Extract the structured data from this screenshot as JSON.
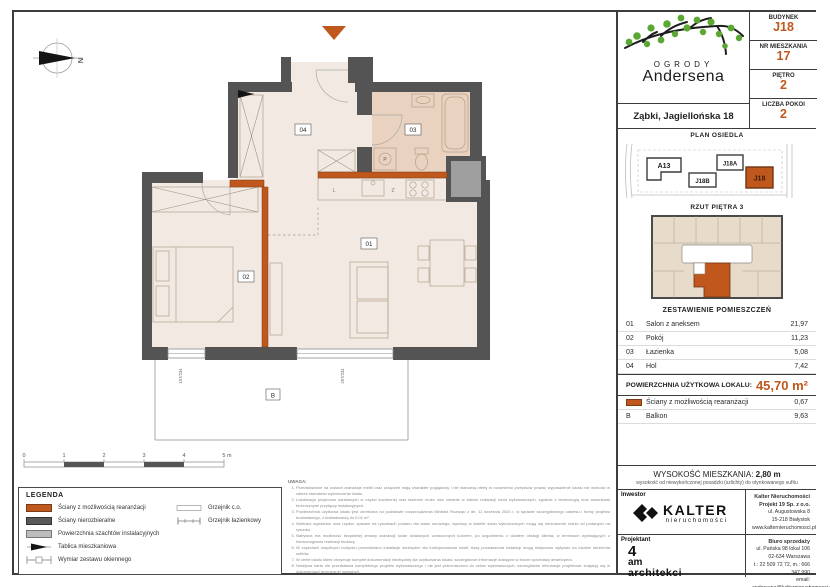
{
  "accent": "#c0571c",
  "header": {
    "brand_top": "OGRODY",
    "brand_bottom": "Andersena",
    "location": "Ząbki, Jagiellońska 18",
    "fields": [
      {
        "label": "BUDYNEK",
        "value": "J18"
      },
      {
        "label": "NR MIESZKANIA",
        "value": "17"
      },
      {
        "label": "PIĘTRO",
        "value": "2"
      },
      {
        "label": "LICZBA POKOI",
        "value": "2"
      }
    ]
  },
  "site": {
    "title": "PLAN OSIEDLA",
    "b_a13": "A13",
    "b_j18b": "J18B",
    "b_j18a": "J18A",
    "b_j18": "J18"
  },
  "thumb": {
    "title": "RZUT PIĘTRA 3"
  },
  "rooms": {
    "title": "ZESTAWIENIE POMIESZCZEŃ",
    "rows": [
      {
        "no": "01",
        "name": "Salon z aneksem",
        "area": "21,97"
      },
      {
        "no": "02",
        "name": "Pokój",
        "area": "11,23"
      },
      {
        "no": "03",
        "name": "Łazienka",
        "area": "5,08"
      },
      {
        "no": "04",
        "name": "Hol",
        "area": "7,42"
      }
    ],
    "total_label": "POWIERZCHNIA UŻYTKOWA LOKALU:",
    "total_value": "45,70 m²",
    "extra1": {
      "name": "Ściany z możliwością rearanżacji",
      "area": "0,67"
    },
    "extra2": {
      "no": "B",
      "name": "Balkon",
      "area": "9,63"
    }
  },
  "height": {
    "label": "WYSOKOŚĆ MIESZKANIA:",
    "value": "2,80 m",
    "note": "wysokość od niewykończonej posadzki (szlichty) do otynkowanego sufitu"
  },
  "footer": {
    "investor_label": "Inwestor",
    "investor_name": "KALTER",
    "investor_sub": "nieruchomości",
    "company": [
      "Kalter Nieruchomości Projekt 19 Sp. z o.o.",
      "ul. Augustowska 8",
      "15-218 Białystok",
      "www.kalternieruchomosci.pl"
    ],
    "designer_label": "Projektant",
    "designer_1": "4",
    "designer_2": "am",
    "designer_3": "architekci",
    "sales_label": "Biuro sprzedaży",
    "sales": [
      "ul. Pańska 98 lokal 106",
      "02-634 Warszawa",
      "t.: 22 509 72 72, m.: 666 347 990",
      "email: andersena@kalternieruchomosci.pl"
    ]
  },
  "plan": {
    "north": "N",
    "labels": {
      "r01": "01",
      "r02": "02",
      "r03": "03",
      "r04": "04",
      "balcony": "B",
      "washer": "P",
      "fridge": "L",
      "dishwasher": "Z"
    },
    "dims": [
      "157/234",
      "257/234"
    ],
    "scale": [
      "0",
      "1",
      "2",
      "3",
      "4",
      "5 m"
    ]
  },
  "legend": {
    "title": "LEGENDA",
    "items": [
      "Ściany z możliwością rearanżacji",
      "Ściany nierozbieralne",
      "Powierzchnia szachtów instalacyjnych",
      "Tablica mieszkaniowa",
      "Wymiar zestawu okiennego"
    ],
    "right": [
      "Grzejnik c.o.",
      "Grzejnik łazienkowy"
    ]
  },
  "notes": {
    "title": "UWAGA:",
    "lines": [
      "Przedstawione na rzutach aranżacje mebli oraz urządzeń mają charakter poglądowy i nie stanowią oferty w rozumieniu przepisów prawa; wyposażenie lokalu nie wchodzi w zakres standardu wykończenia lokalu.",
      "Lokalizacja przyborów sanitarnych w części kuchennej oraz łazience może ulec zmianie w trakcie realizacji robót wykonawczych, zgodnie z technologią oraz warunkami technicznymi przyłączy instalacyjnych.",
      "Powierzchnia użytkowa lokalu jest określona na podstawie rozporządzenia Ministra Rozwoju z dn. 11 września 2020 r. w sprawie szczegółowego zakresu i formy projektu budowlanego, z dokładnością do 0,01 m².",
      "Wartości wymiarów oraz rzędne opisane na rysunkach podano dla stanu surowego; wymiary w świetle ścian wykończonych mogą się nieznacznie różnić od podanych na rysunku.",
      "Nabywca ma możliwość bezpłatnej zmiany aranżacji ścian działowych oznaczonych kolorem, po uzgodnieniu z działem obsługi klienta, w terminach wynikających z harmonogramu realizacji budowy.",
      "W częściach wspólnych budynku przewidziano instalacje niezbędne dla funkcjonowania lokali; trasy prowadzenia instalacji mogą miejscowo wpływać na lokalne obniżenia sufitów.",
      "W cenie lokalu klient otrzymuje komplet dokumentacji niezbędnej dla użytkowania lokalu; szczegółowe informacje dostępne w biurze sprzedaży dewelopera.",
      "Niniejsza karta nie przedstawia kompletnego projektu wykonawczego i nie jest przeznaczona do celów wykonawczych; szczegółowe informacje projektowe znajdują się w dokumentacji technicznej inwestycji.",
      "Projekt chroniony prawem autorskim."
    ]
  }
}
